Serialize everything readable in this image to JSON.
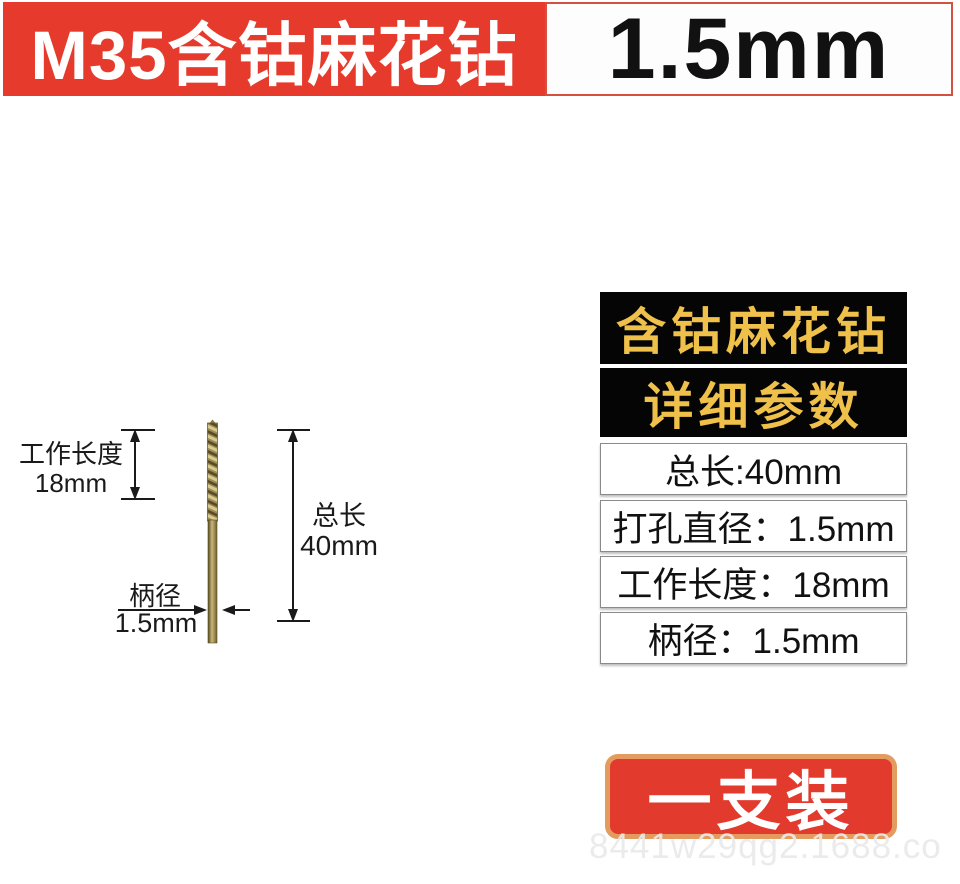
{
  "banner": {
    "title": "M35含钴麻花钻",
    "size": "1.5mm"
  },
  "diagram": {
    "working_length_label": "工作长度",
    "working_length_value": "18mm",
    "total_length_label": "总长",
    "total_length_value": "40mm",
    "shank_label": "柄径",
    "shank_value": "1.5mm"
  },
  "panel": {
    "title": "含钴麻花钻",
    "subtitle": "详细参数",
    "rows": [
      {
        "text": "总长:40mm"
      },
      {
        "text": "打孔直径：1.5mm"
      },
      {
        "text": "工作长度：18mm"
      },
      {
        "text": "柄径：1.5mm"
      }
    ]
  },
  "pack_label": "一支装",
  "watermark": "8441w29qg2.1688.co",
  "colors": {
    "banner_red": "#e63b2c",
    "badge_red": "#e23a2c",
    "gold_text": "#efc04a",
    "tan_border": "#e49b60",
    "panel_black": "#050505"
  }
}
